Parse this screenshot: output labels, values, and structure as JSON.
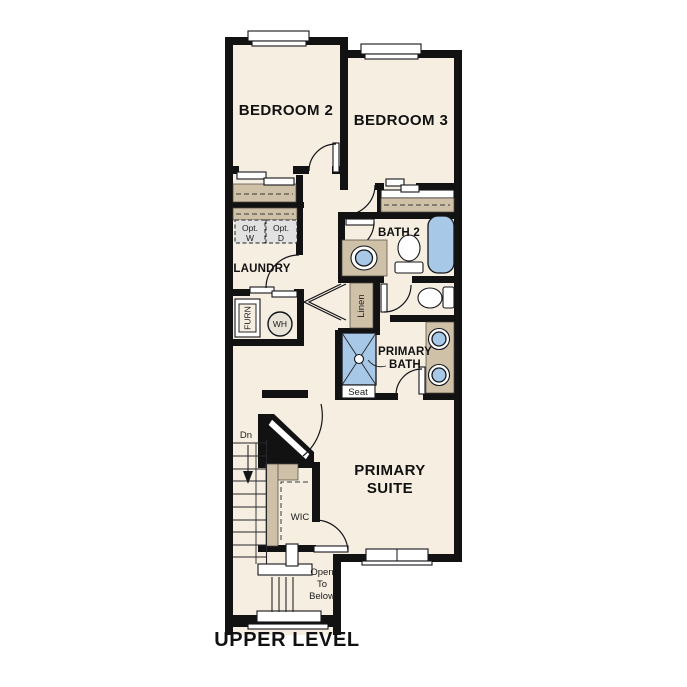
{
  "plan_title": "UPPER LEVEL",
  "rooms": {
    "bedroom2": "BEDROOM 2",
    "bedroom3": "BEDROOM 3",
    "bath2": "BATH 2",
    "laundry": "LAUNDRY",
    "primary_bath": [
      "PRIMARY",
      "BATH"
    ],
    "primary_suite": [
      "PRIMARY",
      "SUITE"
    ],
    "wic": "WIC"
  },
  "annotations": {
    "stair_direction": "Dn",
    "open_to_below": [
      "Open",
      "To",
      "Below"
    ],
    "optional_washer": [
      "Opt.",
      "W"
    ],
    "optional_dryer": [
      "Opt.",
      "D"
    ],
    "furnace": "FURN",
    "water_heater": "WH",
    "linen": "Linen",
    "shower_seat": "Seat"
  },
  "colors": {
    "wall": "#121212",
    "floor": "#f5eee1",
    "casework_tan": "#cec1a8",
    "fixture_blue": "#a7c8e6",
    "optional_gray": "#e2e2e2",
    "background": "#ffffff"
  }
}
